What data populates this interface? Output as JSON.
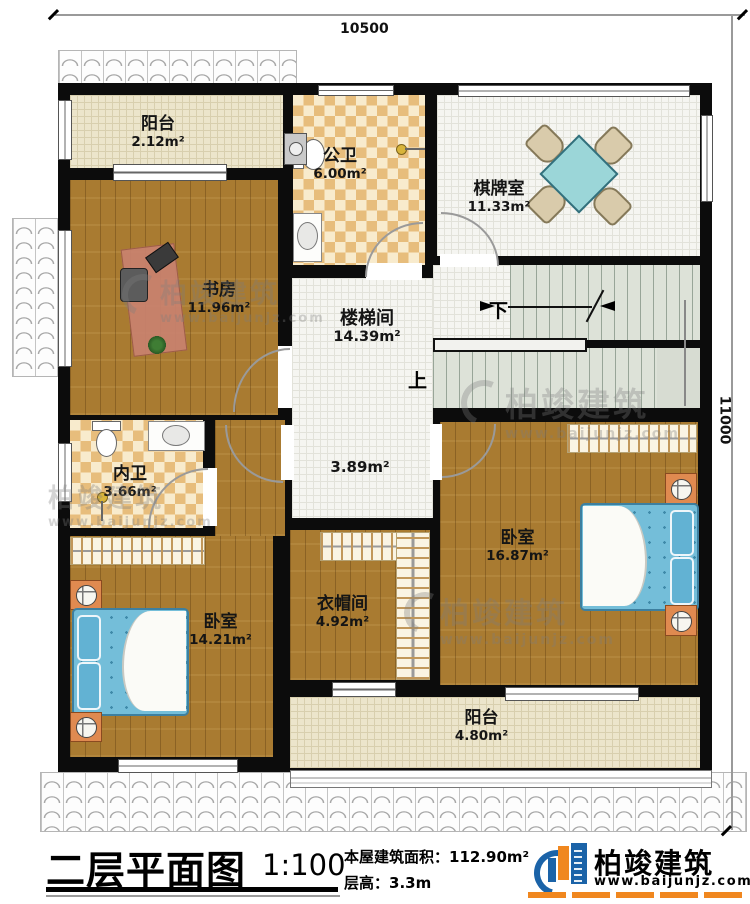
{
  "dimensions": {
    "top": "10500",
    "right": "11000"
  },
  "rooms": {
    "balcony_top": {
      "name": "阳台",
      "area": "2.12m²"
    },
    "public_bath": {
      "name": "公卫",
      "area": "6.00m²"
    },
    "chess_room": {
      "name": "棋牌室",
      "area": "11.33m²"
    },
    "study": {
      "name": "书房",
      "area": "11.96m²"
    },
    "stairwell": {
      "name": "楼梯间",
      "area": "14.39m²"
    },
    "corridor": {
      "area": "3.89m²"
    },
    "inner_bath": {
      "name": "内卫",
      "area": "3.66m²"
    },
    "bedroom_left": {
      "name": "卧室",
      "area": "14.21m²"
    },
    "cloakroom": {
      "name": "衣帽间",
      "area": "4.92m²"
    },
    "bedroom_right": {
      "name": "卧室",
      "area": "16.87m²"
    },
    "balcony_bottom": {
      "name": "阳台",
      "area": "4.80m²"
    }
  },
  "stairs": {
    "up": "上",
    "down": "下"
  },
  "watermark": {
    "name": "柏竣建筑",
    "url": "www.baijunjz.com"
  },
  "titleblock": {
    "title": "二层平面图",
    "scale": "1:100",
    "building_area_label": "本屋建筑面积：",
    "building_area_value": "112.90m²",
    "floor_height_label": "层高：",
    "floor_height_value": "3.3m"
  },
  "logo": {
    "name": "柏竣建筑",
    "url": "www.baijunjz.com"
  },
  "colors": {
    "accent_orange": "#f0871f",
    "brand_blue": "#1b63a8",
    "wall": "#0c0c0c"
  }
}
